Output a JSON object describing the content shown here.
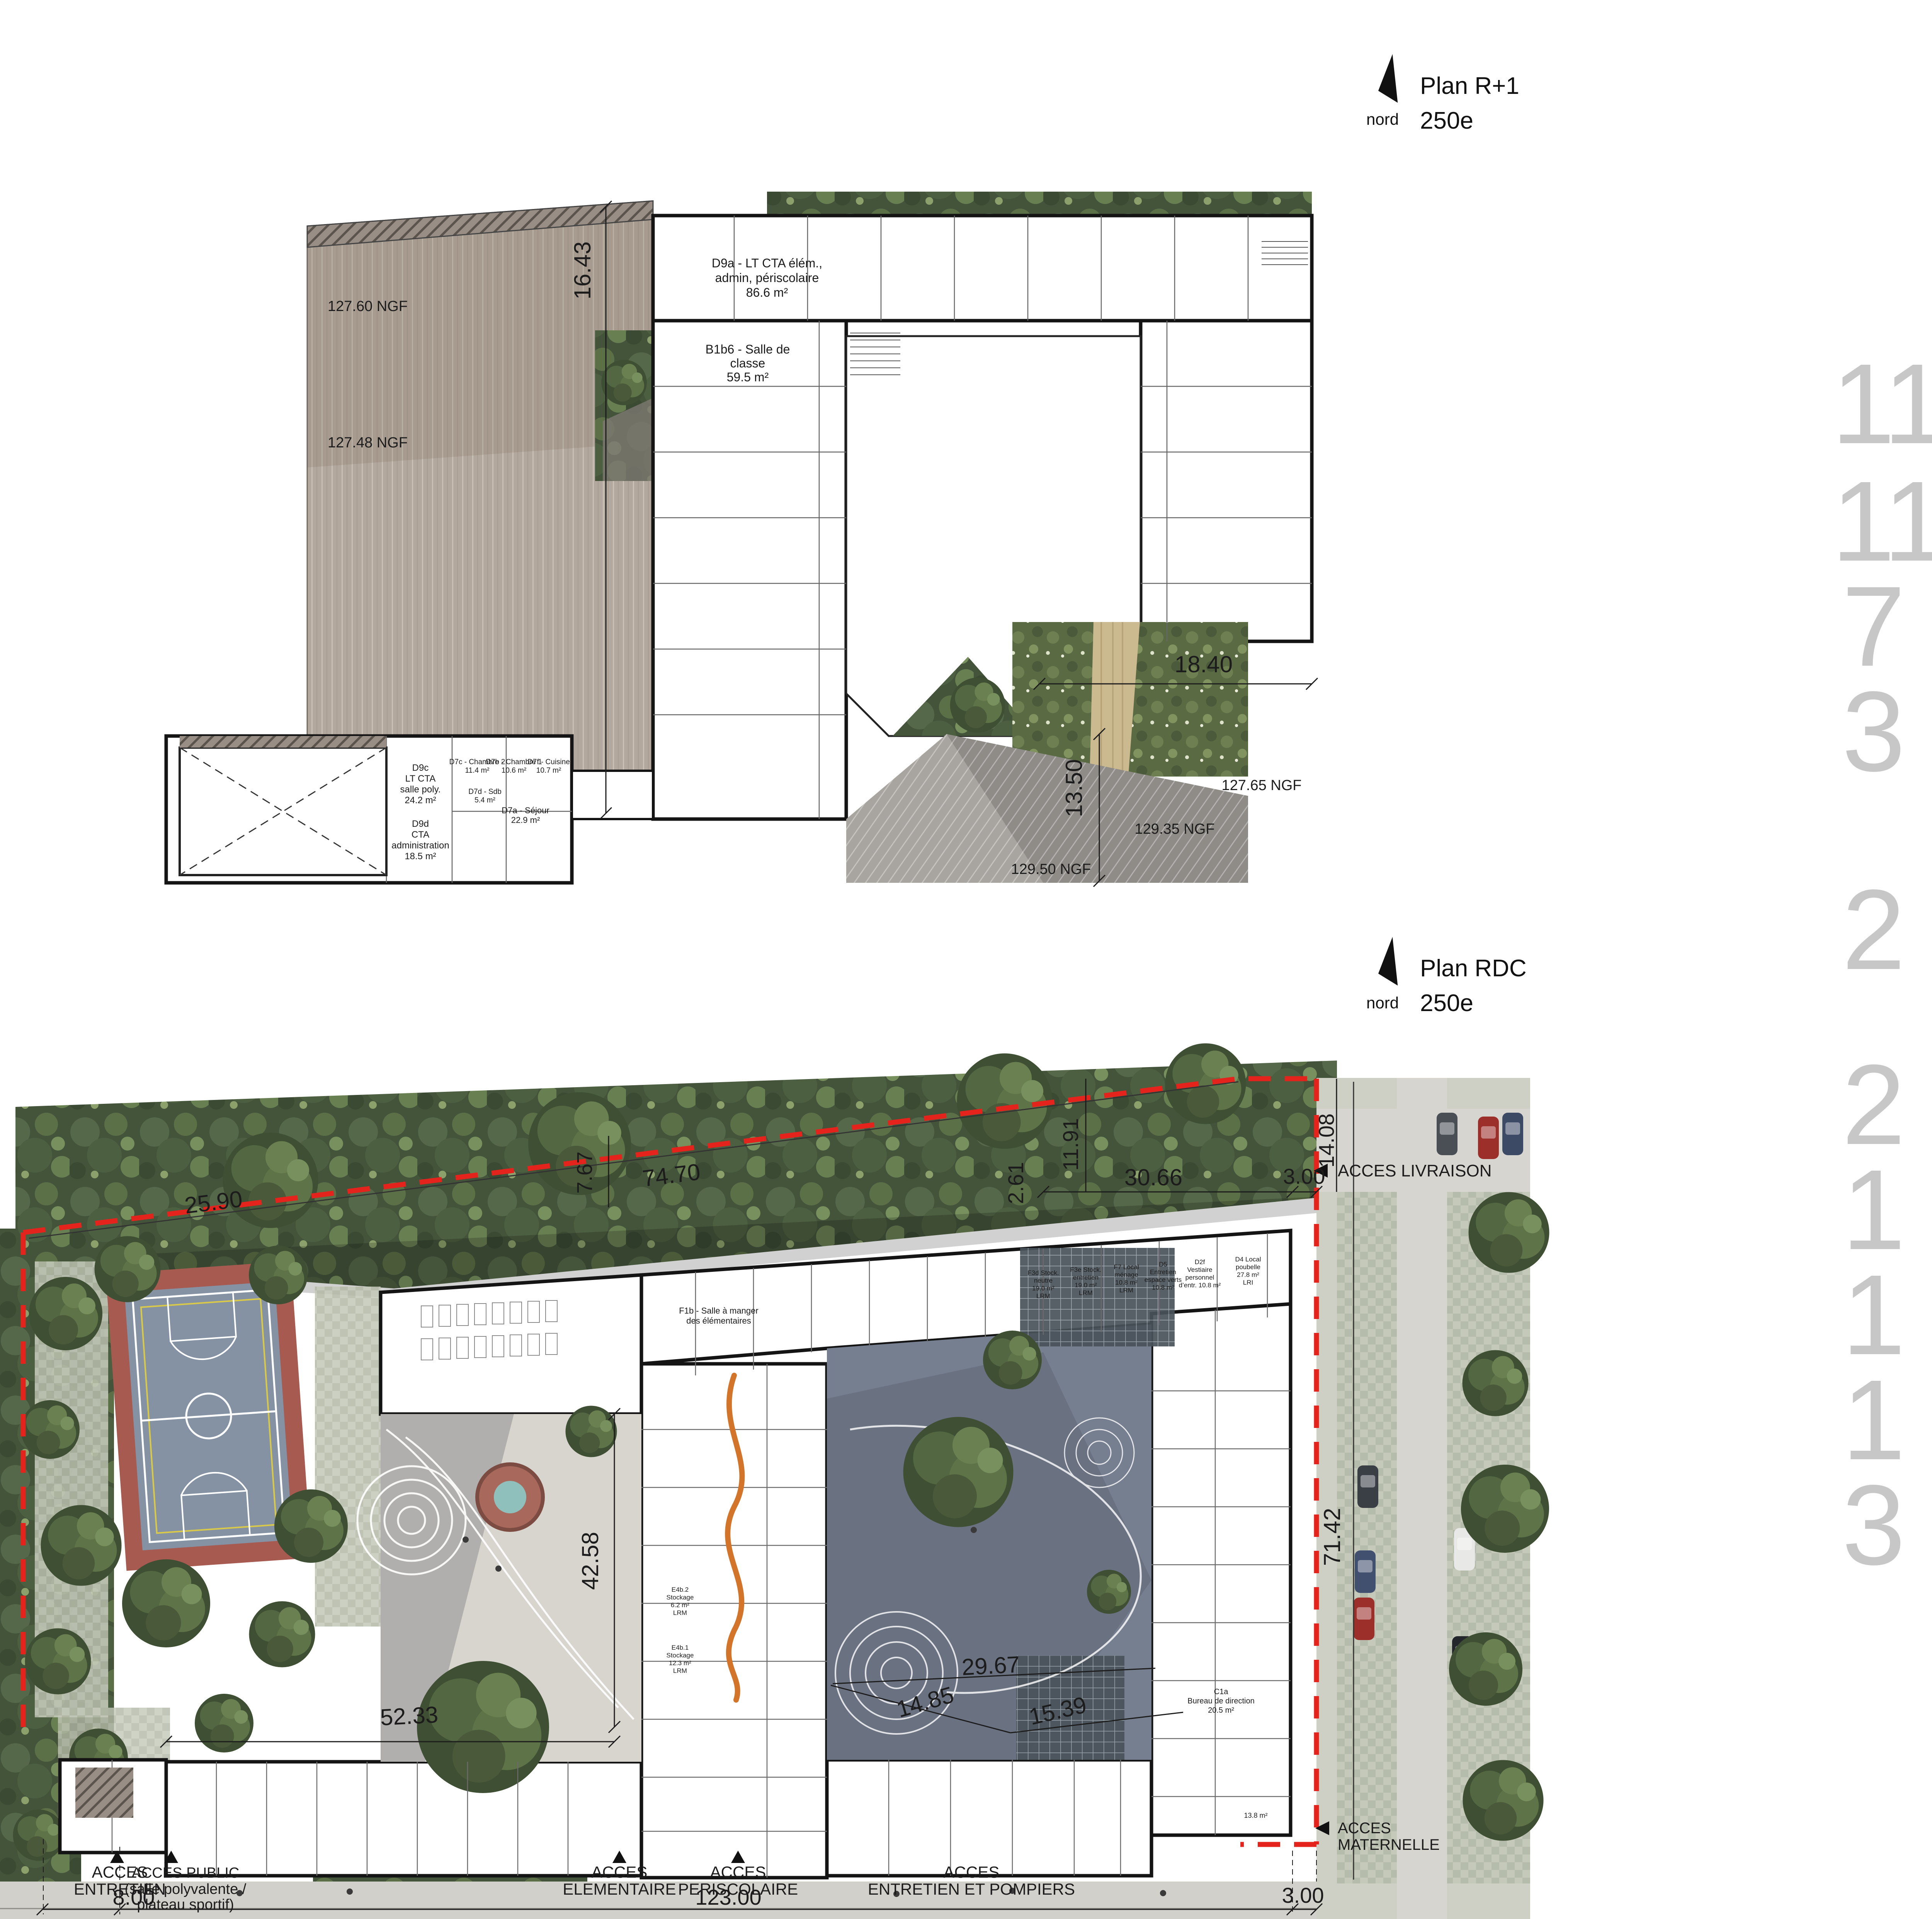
{
  "plan_r1": {
    "title": "Plan R+1",
    "scale_label": "250e",
    "north_label": "nord",
    "dims": {
      "h1643": "16.43",
      "h1840": "18.40",
      "h1350": "13.50"
    },
    "levels": {
      "a": "127.60 NGF",
      "b": "127.48 NGF",
      "c": "127.65 NGF",
      "d": "129.35 NGF",
      "e": "129.50 NGF"
    },
    "rooms": {
      "d9a": [
        "D9a - LT CTA élém.,",
        "admin, périscolaire",
        "86.6 m²"
      ],
      "b1b6": [
        "B1b6 - Salle de",
        "classe",
        "59.5 m²"
      ],
      "d9c": [
        "D9c",
        "LT CTA",
        "salle poly.",
        "24.2 m²"
      ],
      "d9d": [
        "D9d",
        "CTA",
        "administration",
        "18.5 m²"
      ],
      "d7c": [
        "D7c - Chambre 2",
        "11.4 m²"
      ],
      "d7b": [
        "D7b - Chambre 1",
        "10.6 m²"
      ],
      "d7f": [
        "D7f - Cuisine",
        "10.7 m²"
      ],
      "d7a": [
        "D7a - Séjour",
        "22.9 m²"
      ],
      "d7d": [
        "D7d - Sdb",
        "5.4 m²"
      ]
    }
  },
  "plan_rdc": {
    "title": "Plan RDC",
    "scale_label": "250e",
    "north_label": "nord",
    "dims": {
      "d2590": "25.90",
      "d767": "7.67",
      "d7470": "74.70",
      "d261": "2.61",
      "d1191": "11.91",
      "d3066": "30.66",
      "d300t": "3.00",
      "d1408": "14.08",
      "d4258": "42.58",
      "d5233": "52.33",
      "d2967": "29.67",
      "d1485": "14.85",
      "d1539": "15.39",
      "d7142": "71.42",
      "d800": "8.00",
      "d12300": "123.00",
      "d300b": "3.00"
    },
    "access": {
      "entretien": [
        "ACCES",
        "ENTRETIEN"
      ],
      "public": [
        "ACCES PUBLIC",
        "(salle polyvalente /",
        "plateau sportif)"
      ],
      "elementaire": [
        "ACCES",
        "ELEMENTAIRE"
      ],
      "periscolaire": [
        "ACCES",
        "PERISCOLAIRE"
      ],
      "pompiers": [
        "ACCES",
        "ENTRETIEN ET POMPIERS"
      ],
      "livraison": "ACCES LIVRAISON",
      "maternelle": [
        "ACCES",
        "MATERNELLE"
      ]
    },
    "rooms": {
      "f1b": [
        "F1b - Salle à manger",
        "des élémentaires"
      ],
      "c1a": [
        "C1a",
        "Bureau de direction",
        "20.5 m²"
      ],
      "e4b2": [
        "E4b.2",
        "Stockage",
        "6.2 m²",
        "LRM"
      ],
      "e4b1": [
        "E4b.1",
        "Stockage",
        "12.3 m²",
        "LRM"
      ],
      "f3d": [
        "F3d Stock.",
        "neutre",
        "19.0 m²",
        "LRM"
      ],
      "f3e": [
        "F3e Stock.",
        "entretien",
        "19.0 m²",
        "LRM"
      ],
      "f7": [
        "F7 Local",
        "ménage",
        "10.8 m²",
        "LRM"
      ],
      "d5": [
        "D5",
        "Entretien",
        "espace verts",
        "10.8 m²"
      ],
      "d2f": [
        "D2f",
        "Vestiaire",
        "personnel",
        "d’entr. 10.8 m²"
      ],
      "d4": [
        "D4 Local",
        "poubelle",
        "27.8 m²",
        "LRI"
      ],
      "s138": "13.8 m²"
    }
  },
  "legend": {
    "items": [
      {
        "num": "11",
        "label": "CLASSES MATERNELLES",
        "subs": []
      },
      {
        "num": "11",
        "label": "CLASSES ELEMENTAIRES",
        "subs": []
      },
      {
        "num": "7",
        "label": "SALLES PERISCOLAIRES",
        "subs": []
      },
      {
        "num": "3",
        "label": "SALLES A MANGER",
        "subs": [
          "_Maternelle",
          "_Elémentaire",
          "_Adultes"
        ]
      },
      {
        "num": "2",
        "label": "SALLES DE SPORT",
        "subs": [
          "_Motricité pour la Maternelle",
          "_Polyvalente pour l’Elémentaire"
        ]
      },
      {
        "num": "2",
        "label": "COURS OASIS",
        "subs": []
      },
      {
        "num": "1",
        "label": "TERRAIN DE SPORT",
        "subs": []
      },
      {
        "num": "1",
        "label": "BCD",
        "subs": []
      },
      {
        "num": "1",
        "label": "CUISINE EN LIAISON FROIDE",
        "subs": []
      },
      {
        "num": "3",
        "label": "DIRECTIONS",
        "subs": [
          "_Maternelle",
          "_Elémentaire",
          "_Périscolaire"
        ]
      }
    ]
  },
  "colors": {
    "property_line_red": "#e3231c",
    "legend_number_gray": "#c7c7c7",
    "deck_taupe": "#b3a89d",
    "court_slate": "#767f90",
    "sport_red": "#a65a50",
    "sport_blue": "#8592a4",
    "orange_path": "#d2752b"
  }
}
